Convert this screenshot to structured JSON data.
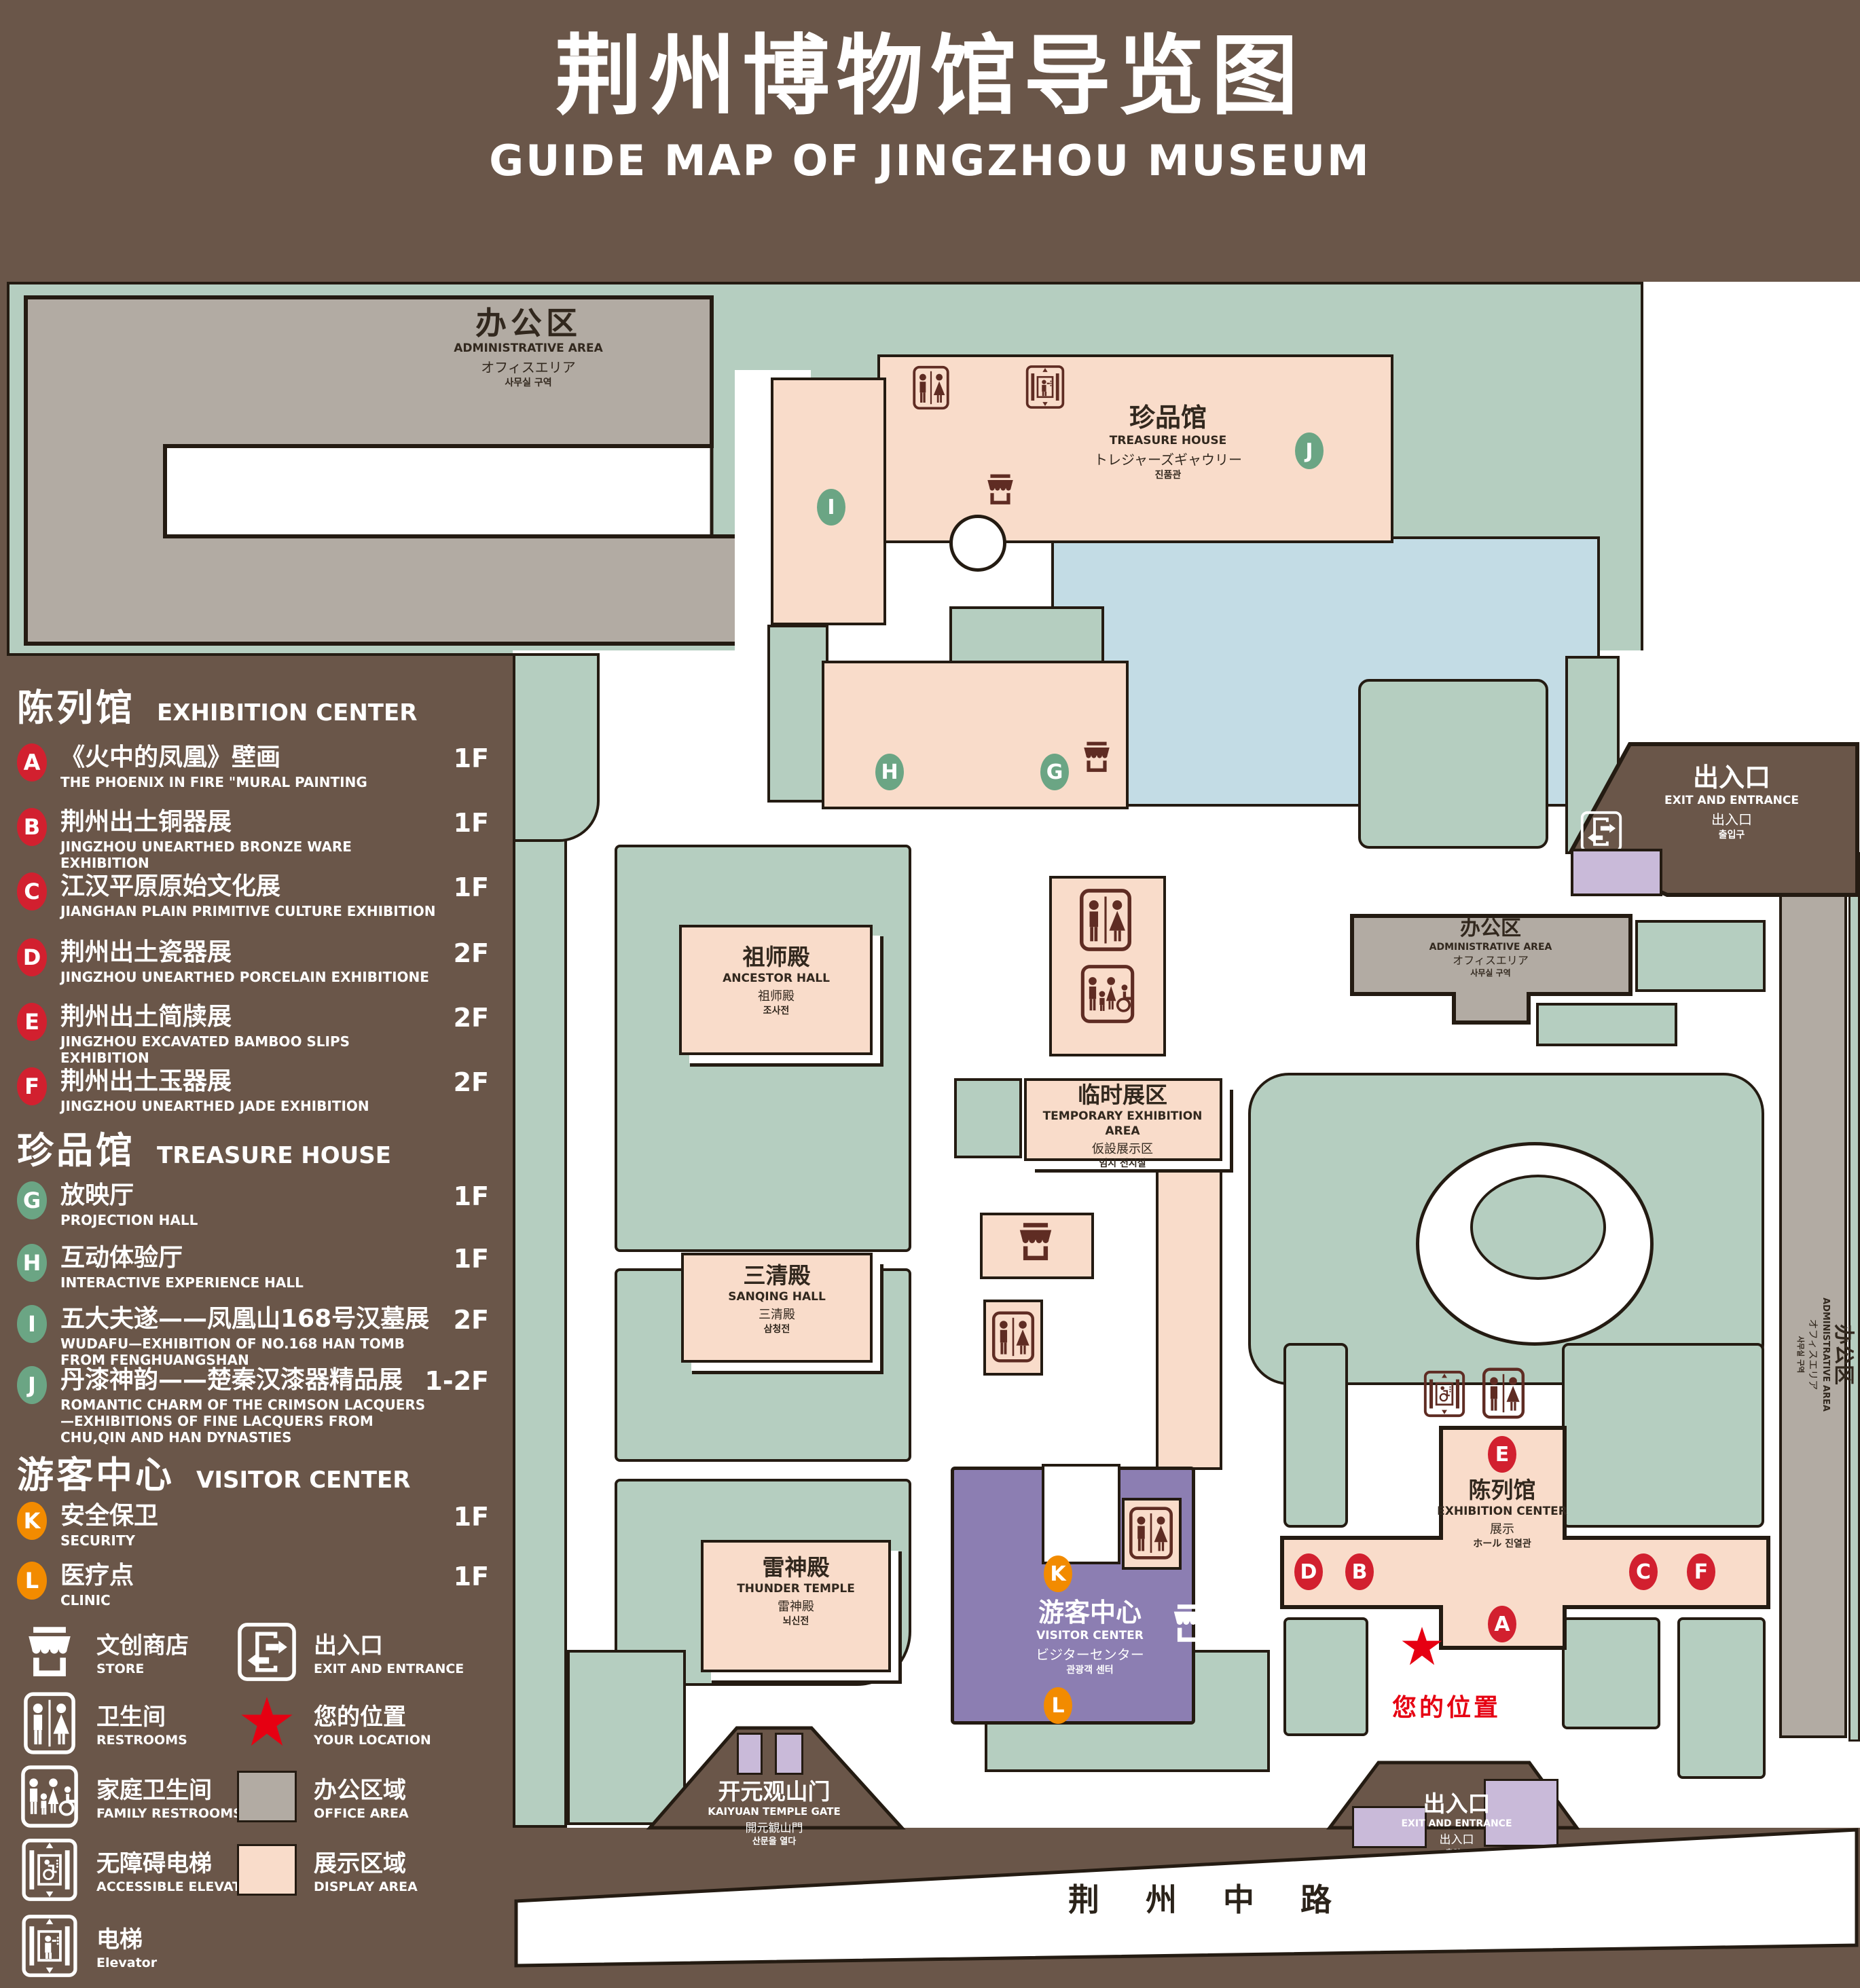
{
  "title": {
    "zh": "荆州博物馆导览图",
    "en": "GUIDE MAP OF JINGZHOU MUSEUM"
  },
  "colors": {
    "background": "#6a5649",
    "green_area": "#b5cec0",
    "display_area": "#f9dcca",
    "office_area": "#b2aba3",
    "water": "#c3dce5",
    "visitor_center_purple": "#8c7eb2",
    "small_building_lavender": "#c9bad9",
    "outline": "#241b12",
    "badge_red": "#d2202f",
    "badge_green": "#6ba584",
    "badge_orange": "#f28b00",
    "location_red": "#e60012",
    "icon_maroon": "#5f2c23"
  },
  "legend": {
    "sections": [
      {
        "zh": "陈列馆",
        "en": "EXHIBITION CENTER",
        "items": [
          {
            "letter": "A",
            "zh": "《火中的凤凰》壁画",
            "en": "THE PHOENIX IN FIRE \"MURAL PAINTING",
            "floor": "1F"
          },
          {
            "letter": "B",
            "zh": "荆州出土铜器展",
            "en": "JINGZHOU UNEARTHED BRONZE WARE EXHIBITION",
            "floor": "1F"
          },
          {
            "letter": "C",
            "zh": "江汉平原原始文化展",
            "en": "JIANGHAN PLAIN PRIMITIVE CULTURE EXHIBITION",
            "floor": "1F"
          },
          {
            "letter": "D",
            "zh": "荆州出土瓷器展",
            "en": "JINGZHOU UNEARTHED PORCELAIN EXHIBITIONE",
            "floor": "2F"
          },
          {
            "letter": "E",
            "zh": "荆州出土简牍展",
            "en": "JINGZHOU EXCAVATED BAMBOO SLIPS EXHIBITION",
            "floor": "2F"
          },
          {
            "letter": "F",
            "zh": "荆州出土玉器展",
            "en": "JINGZHOU UNEARTHED JADE EXHIBITION",
            "floor": "2F"
          }
        ]
      },
      {
        "zh": "珍品馆",
        "en": "TREASURE HOUSE",
        "items": [
          {
            "letter": "G",
            "zh": "放映厅",
            "en": "PROJECTION HALL",
            "floor": "1F"
          },
          {
            "letter": "H",
            "zh": "互动体验厅",
            "en": "INTERACTIVE EXPERIENCE HALL",
            "floor": "1F"
          },
          {
            "letter": "I",
            "zh": "五大夫遂——凤凰山168号汉墓展",
            "en": "WUDAFU—EXHIBITION OF NO.168 HAN TOMB FROM FENGHUANGSHAN",
            "floor": "2F"
          },
          {
            "letter": "J",
            "zh": "丹漆神韵——楚秦汉漆器精品展",
            "en": "ROMANTIC CHARM OF THE CRIMSON LACQUERS—EXHIBITIONS OF FINE LACQUERS FROM CHU,QIN AND HAN DYNASTIES",
            "floor": "1-2F"
          }
        ]
      },
      {
        "zh": "游客中心",
        "en": "VISITOR CENTER",
        "items": [
          {
            "letter": "K",
            "zh": "安全保卫",
            "en": "SECURITY",
            "floor": "1F"
          },
          {
            "letter": "L",
            "zh": "医疗点",
            "en": "CLINIC",
            "floor": "1F"
          }
        ]
      }
    ],
    "symbols": [
      {
        "zh": "文创商店",
        "en": "STORE"
      },
      {
        "zh": "出入口",
        "en": "EXIT AND ENTRANCE"
      },
      {
        "zh": "卫生间",
        "en": "RESTROOMS"
      },
      {
        "zh": "您的位置",
        "en": "YOUR LOCATION"
      },
      {
        "zh": "家庭卫生间",
        "en": "FAMILY RESTROOMS"
      },
      {
        "zh": "办公区域",
        "en": "OFFICE AREA"
      },
      {
        "zh": "无障碍电梯",
        "en": "ACCESSIBLE ELEVATOR"
      },
      {
        "zh": "展示区域",
        "en": "DISPLAY AREA"
      },
      {
        "zh": "电梯",
        "en": "Elevator"
      }
    ]
  },
  "map": {
    "buildings": {
      "admin": {
        "lines": [
          "办公区",
          "ADMINISTRATIVE AREA",
          "オフィスエリア",
          "사무실 구역"
        ]
      },
      "treasure": {
        "lines": [
          "珍品馆",
          "TREASURE HOUSE",
          "トレジャーズギャウリー",
          "진품관"
        ]
      },
      "ancestor": {
        "lines": [
          "祖师殿",
          "ANCESTOR HALL",
          "祖师殿",
          "조사전"
        ]
      },
      "temporary": {
        "lines": [
          "临时展区",
          "TEMPORARY EXHIBITION AREA",
          "仮設展示区",
          "임시 전시실"
        ]
      },
      "sanqing": {
        "lines": [
          "三清殿",
          "SANQING HALL",
          "三清殿",
          "삼청전"
        ]
      },
      "thunder": {
        "lines": [
          "雷神殿",
          "THUNDER TEMPLE",
          "雷神殿",
          "뇌신전"
        ]
      },
      "visitor": {
        "lines": [
          "游客中心",
          "VISITOR CENTER",
          "ビジターセンター",
          "관광객 센터"
        ]
      },
      "exhibition": {
        "lines": [
          "陈列馆",
          "EXHIBITION CENTER",
          "展示",
          "ホール 진열관"
        ]
      },
      "gate": {
        "lines": [
          "开元观山门",
          "KAIYUAN TEMPLE GATE",
          "開元観山門",
          "산문을 열다"
        ]
      },
      "exit": {
        "lines": [
          "出入口",
          "EXIT AND ENTRANCE",
          "出入口",
          "출입구"
        ]
      }
    },
    "markers": [
      "A",
      "B",
      "C",
      "D",
      "E",
      "F",
      "G",
      "H",
      "I",
      "J",
      "K",
      "L"
    ],
    "road": "荆 州 中 路",
    "your_location": "您的位置"
  }
}
